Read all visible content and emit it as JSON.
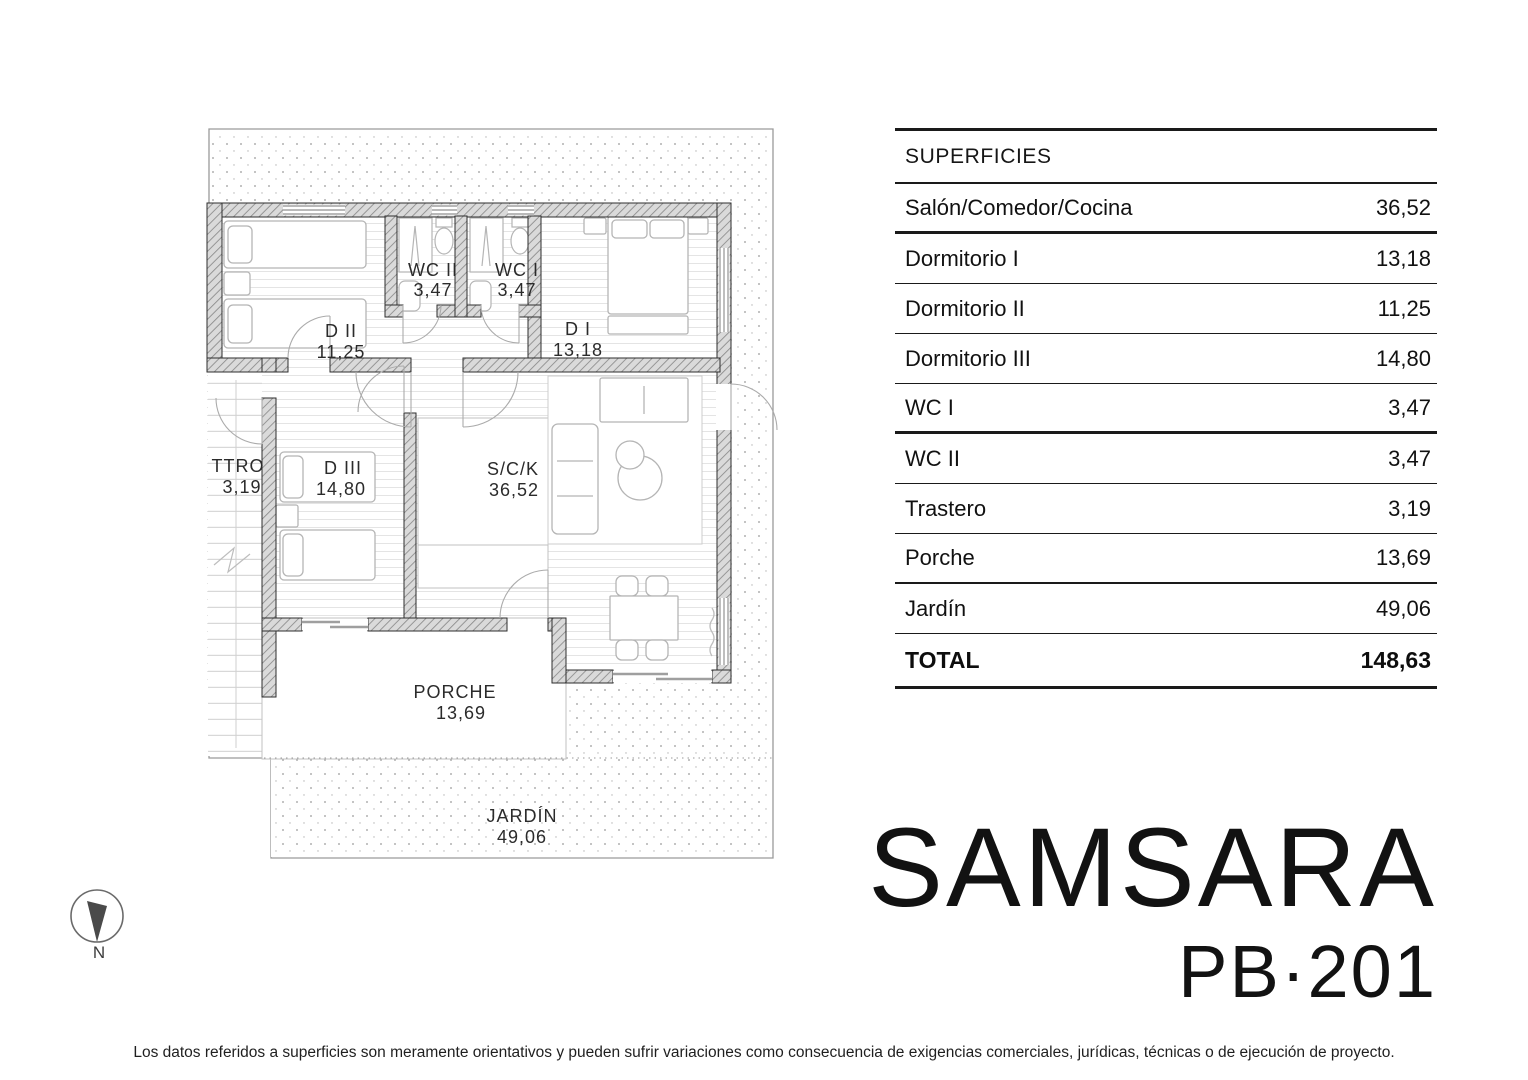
{
  "colors": {
    "ink": "#1a1a1a",
    "wall_hatch": "#8a8a8a",
    "furniture_line": "#b5b5b5",
    "stipple": "#9a9a9a"
  },
  "table": {
    "header": "SUPERFICIES",
    "rows": [
      {
        "label": "Salón/Comedor/Cocina",
        "value": "36,52"
      },
      {
        "label": "Dormitorio I",
        "value": "13,18"
      },
      {
        "label": "Dormitorio II",
        "value": "11,25"
      },
      {
        "label": "Dormitorio III",
        "value": "14,80"
      },
      {
        "label": "WC I",
        "value": "3,47"
      },
      {
        "label": "WC II",
        "value": "3,47"
      },
      {
        "label": "Trastero",
        "value": "3,19"
      },
      {
        "label": "Porche",
        "value": "13,69"
      },
      {
        "label": "Jardín",
        "value": "49,06"
      }
    ],
    "total_label": "TOTAL",
    "total_value": "148,63"
  },
  "plan": {
    "rooms": [
      {
        "id": "d2",
        "label": "D II",
        "area": "11,25"
      },
      {
        "id": "wc2",
        "label": "WC II",
        "area": "3,47"
      },
      {
        "id": "wc1",
        "label": "WC I",
        "area": "3,47"
      },
      {
        "id": "d1",
        "label": "D I",
        "area": "13,18"
      },
      {
        "id": "ttro",
        "label": "TTRO",
        "area": "3,19"
      },
      {
        "id": "d3",
        "label": "D III",
        "area": "14,80"
      },
      {
        "id": "sck",
        "label": "S/C/K",
        "area": "36,52"
      },
      {
        "id": "porche",
        "label": "PORCHE",
        "area": "13,69"
      },
      {
        "id": "jardin",
        "label": "JARDÍN",
        "area": "49,06"
      }
    ],
    "compass_label": "N"
  },
  "title": {
    "project": "SAMSARA",
    "unit": "PB·201"
  },
  "footer": {
    "disclaimer": "Los datos referidos a superficies son meramente orientativos y pueden sufrir variaciones como consecuencia de exigencias comerciales, jurídicas, técnicas o de ejecución de proyecto."
  }
}
